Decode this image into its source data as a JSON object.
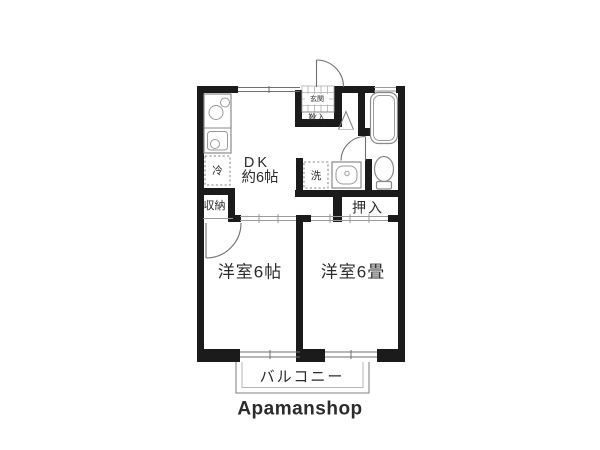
{
  "floor_plan": {
    "labels": {
      "entrance": "玄関",
      "shoe_box": "靴入",
      "dk": "DK",
      "dk_size": "約6帖",
      "fridge": "冷",
      "laundry": "洗",
      "storage": "収納",
      "closet": "押入",
      "room_left": "洋室6帖",
      "room_right": "洋室6畳",
      "balcony": "バルコニー"
    },
    "brand": "Apamanshop",
    "colors": {
      "wall": "#1b1b1b",
      "fixture_line": "#8a8a8a",
      "text": "#2b2b2b",
      "balcony_text": "#a9a9a9",
      "brand_text": "#4f4f4f"
    }
  }
}
